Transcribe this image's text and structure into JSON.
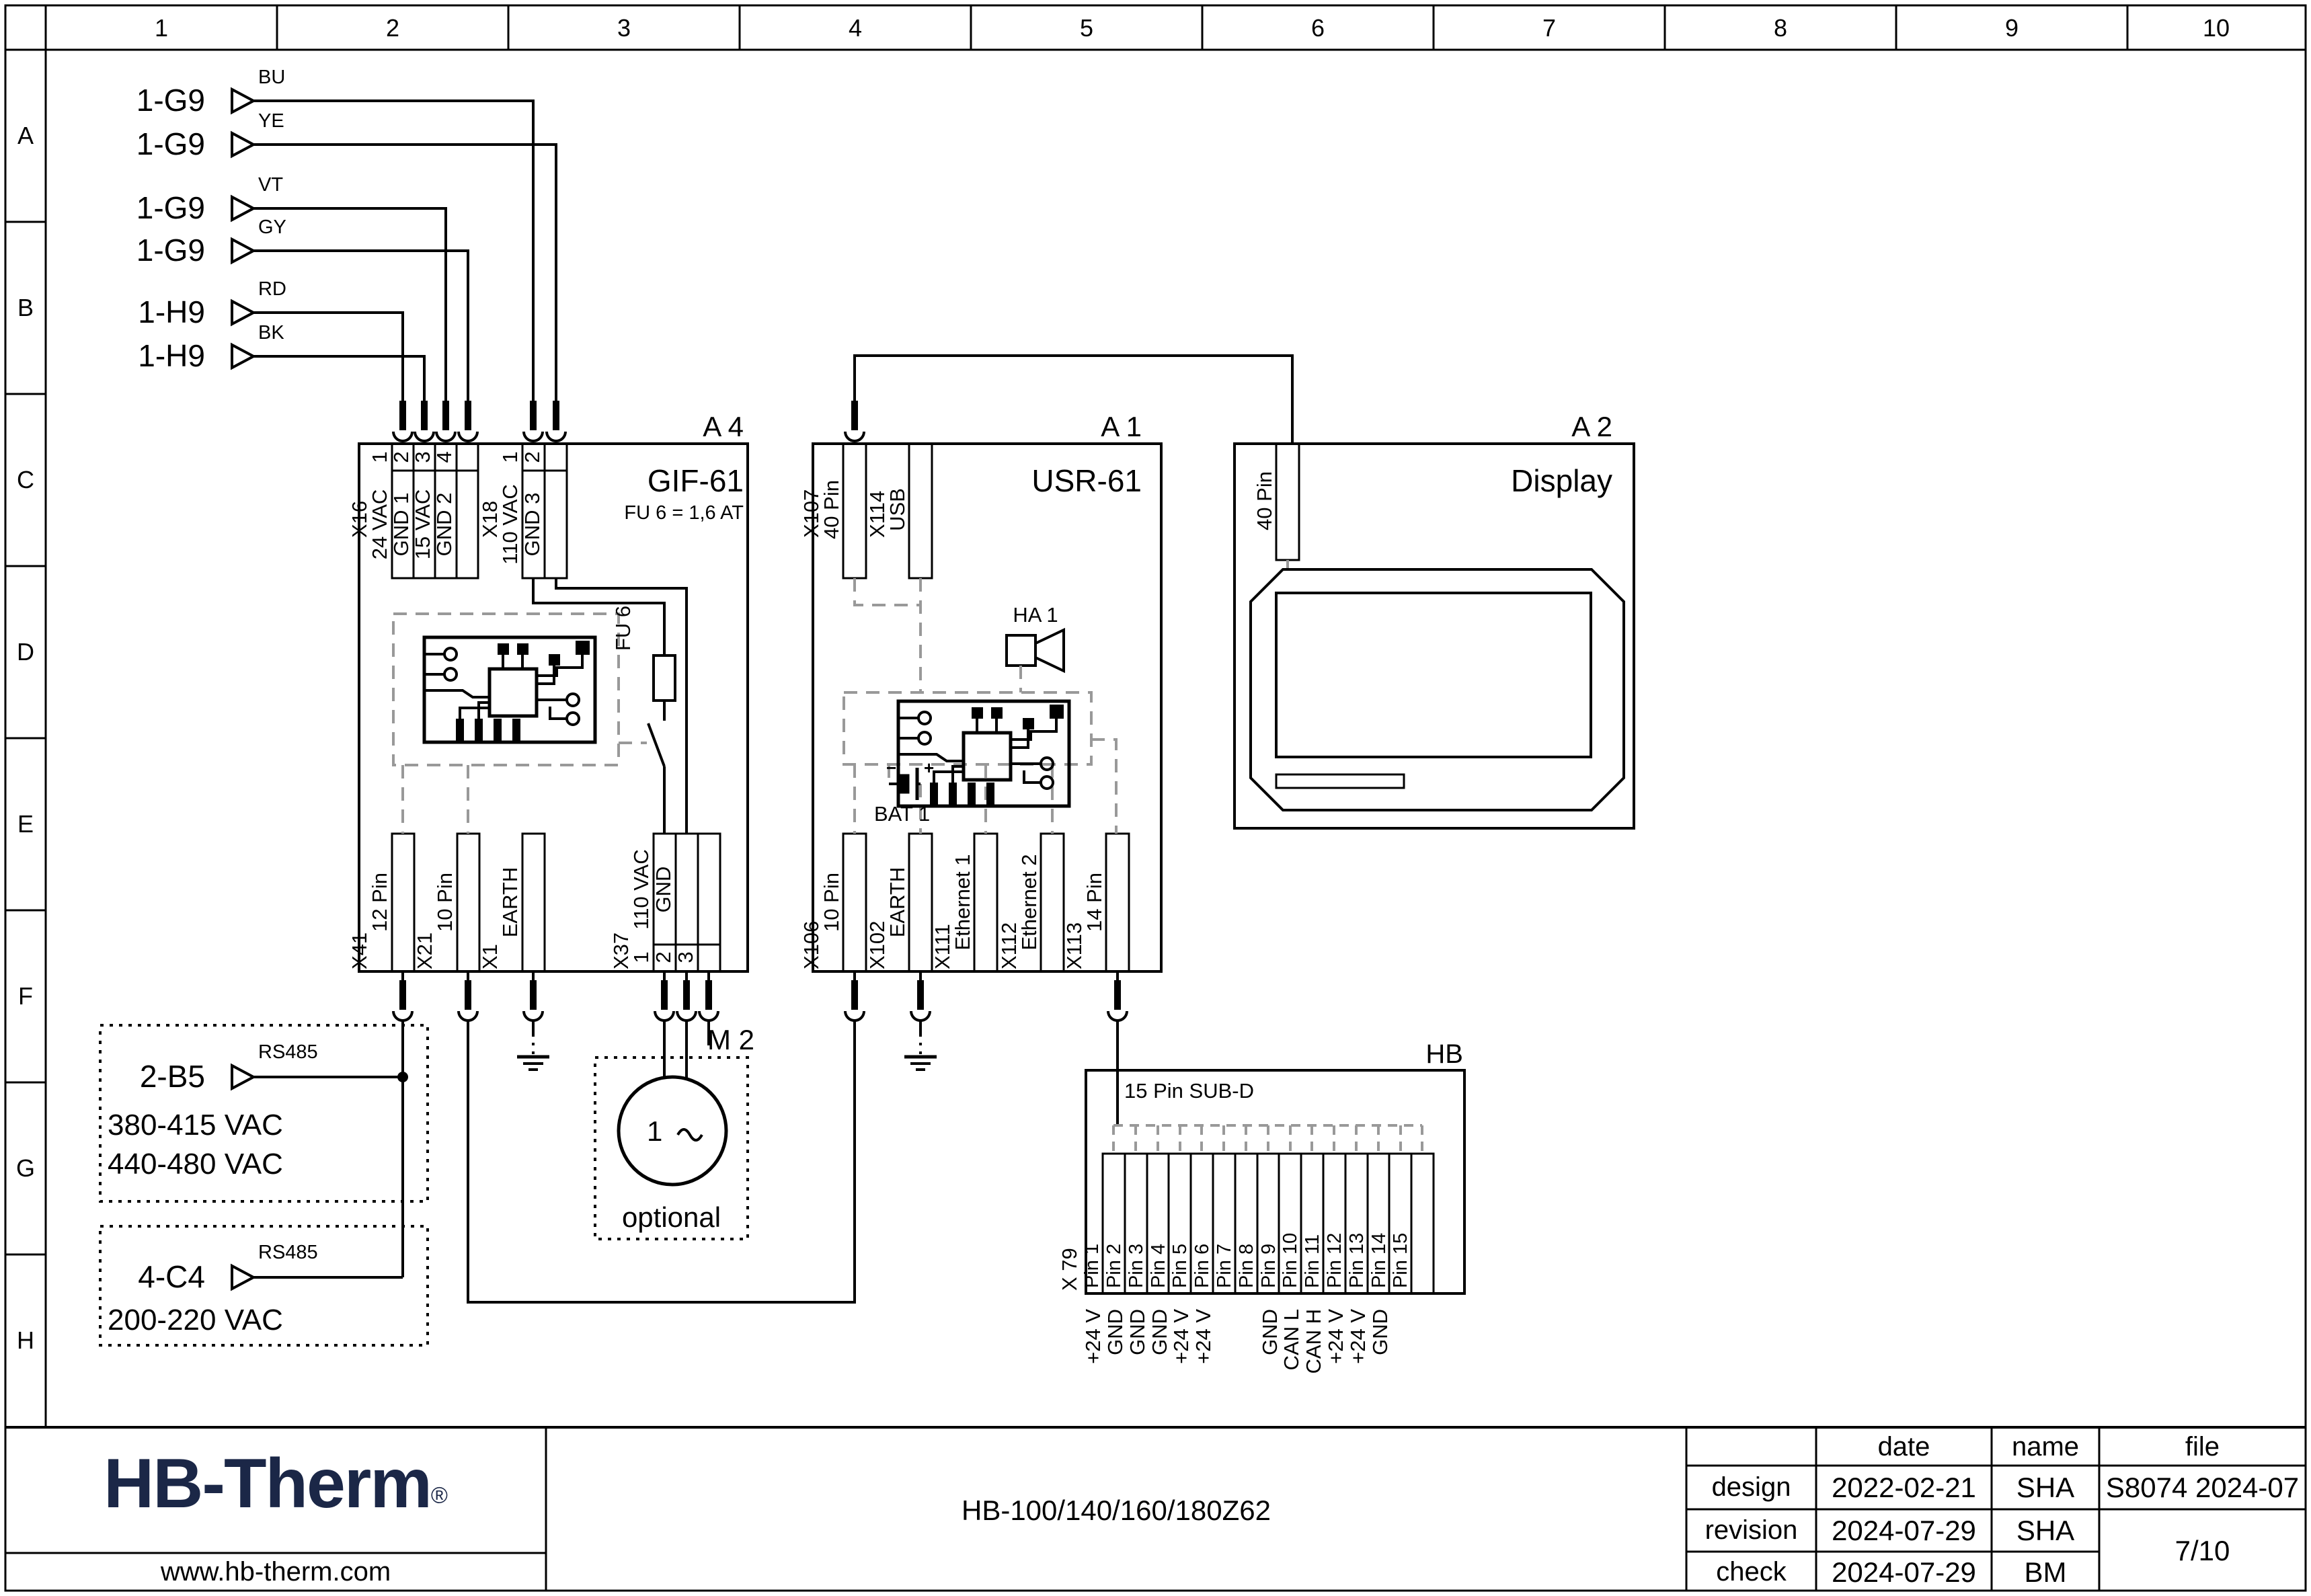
{
  "colors": {
    "line": "#000000",
    "dashed_gray": "#999999",
    "logo_navy": "#1b2747"
  },
  "grid": {
    "columns": [
      "1",
      "2",
      "3",
      "4",
      "5",
      "6",
      "7",
      "8",
      "9",
      "10"
    ],
    "rows": [
      "A",
      "B",
      "C",
      "D",
      "E",
      "F",
      "G",
      "H"
    ]
  },
  "sources": [
    {
      "ref": "1-G9",
      "code": "BU"
    },
    {
      "ref": "1-G9",
      "code": "YE"
    },
    {
      "ref": "1-G9",
      "code": "VT"
    },
    {
      "ref": "1-G9",
      "code": "GY"
    },
    {
      "ref": "1-H9",
      "code": "RD"
    },
    {
      "ref": "1-H9",
      "code": "BK"
    }
  ],
  "a4": {
    "id": "A 4",
    "name": "GIF-61",
    "fuse_note": "FU 6 = 1,6 AT",
    "fuse_label": "FU 6",
    "x16": {
      "id": "X16",
      "pins": [
        {
          "n": "1",
          "label": "24 VAC"
        },
        {
          "n": "2",
          "label": "GND 1"
        },
        {
          "n": "3",
          "label": "15 VAC"
        },
        {
          "n": "4",
          "label": "GND 2"
        }
      ]
    },
    "x18": {
      "id": "X18",
      "pins": [
        {
          "n": "1",
          "label": "110 VAC"
        },
        {
          "n": "2",
          "label": "GND 3"
        }
      ]
    },
    "x41": {
      "id": "X41",
      "label": "12 Pin"
    },
    "x21": {
      "id": "X21",
      "label": "10 Pin"
    },
    "x1": {
      "id": "X1",
      "label": "EARTH"
    },
    "x37": {
      "id": "X37",
      "pins": [
        {
          "n": "1",
          "label": "110 VAC"
        },
        {
          "n": "2",
          "label": "GND"
        },
        {
          "n": "3",
          "label": ""
        }
      ]
    }
  },
  "a1": {
    "id": "A 1",
    "name": "USR-61",
    "horn": "HA 1",
    "battery": "BAT 1",
    "battery_minus": "−",
    "battery_plus": "+",
    "x107": {
      "id": "X107",
      "label": "40 Pin"
    },
    "x114": {
      "id": "X114",
      "label": "USB"
    },
    "x106": {
      "id": "X106",
      "label": "10 Pin"
    },
    "x102": {
      "id": "X102",
      "label": "EARTH"
    },
    "x111": {
      "id": "X111",
      "label": "Ethernet 1"
    },
    "x112": {
      "id": "X112",
      "label": "Ethernet 2"
    },
    "x113": {
      "id": "X113",
      "label": "14 Pin"
    }
  },
  "a2": {
    "id": "A 2",
    "name": "Display",
    "conn": "40 Pin"
  },
  "m2": {
    "id": "M 2",
    "note": "optional",
    "phase": "1"
  },
  "hb": {
    "id": "HB",
    "conn_label": "15 Pin SUB-D",
    "x79": "X 79",
    "pins": [
      "Pin 1",
      "Pin 2",
      "Pin 3",
      "Pin 4",
      "Pin 5",
      "Pin 6",
      "Pin 7",
      "Pin 8",
      "Pin 9",
      "Pin 10",
      "Pin 11",
      "Pin 12",
      "Pin 13",
      "Pin 14",
      "Pin 15"
    ],
    "signals": [
      "+24 V",
      "GND",
      "GND",
      "GND",
      "+24 V",
      "+24 V",
      "",
      "",
      "GND",
      "CAN L",
      "CAN H",
      "+24 V",
      "+24 V",
      "GND",
      ""
    ]
  },
  "feeds": {
    "b5": {
      "ref": "2-B5",
      "bus": "RS485",
      "v1": "380-415 VAC",
      "v2": "440-480 VAC"
    },
    "c4": {
      "ref": "4-C4",
      "bus": "RS485",
      "v1": "200-220 VAC"
    }
  },
  "titleblock": {
    "logo": "HB-Therm",
    "reg": "®",
    "site": "www.hb-therm.com",
    "title": "HB-100/140/160/180Z62",
    "cols": {
      "date": "date",
      "name": "name",
      "file": "file"
    },
    "rows": {
      "design": "design",
      "revision": "revision",
      "check": "check"
    },
    "design_date": "2022-02-21",
    "design_name": "SHA",
    "revision_date": "2024-07-29",
    "revision_name": "SHA",
    "check_date": "2024-07-29",
    "check_name": "BM",
    "file_id": "S8074 2024-07",
    "page": "7/10"
  }
}
